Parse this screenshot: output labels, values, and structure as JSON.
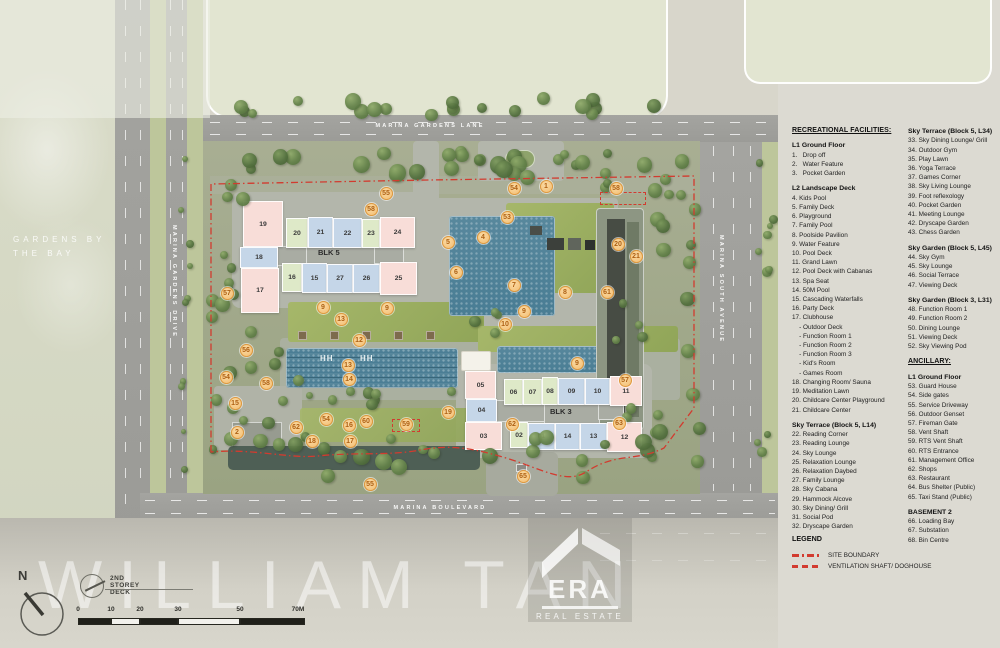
{
  "labels": {
    "watermark": "WILLIAM TAN",
    "area_line1": "GARDENS BY",
    "area_line2": "THE BAY",
    "deck_note": "2ND STOREY DECK",
    "north": "N"
  },
  "roads": {
    "top": "MARINA GARDENS LANE",
    "left": "MARINA GARDENS DRIVE",
    "right": "MARINA SOUTH AVENUE",
    "bottom": "MARINA BOULEVARD"
  },
  "scale_bar": {
    "labels": [
      "0",
      "10",
      "20",
      "30",
      "50",
      "70M"
    ]
  },
  "logo": {
    "name": "ERA",
    "subtitle": "REAL ESTATE"
  },
  "map": {
    "lane_mark": "HH",
    "blocks": [
      {
        "name": "BLK 5",
        "label_x": 318,
        "label_y": 248,
        "cores": [
          {
            "x": 262,
            "y": 246,
            "w": 48,
            "h": 20
          },
          {
            "x": 306,
            "y": 242,
            "w": 70,
            "h": 24
          },
          {
            "x": 374,
            "y": 246,
            "w": 30,
            "h": 18
          }
        ],
        "cells": [
          {
            "label": "19",
            "x": 243,
            "y": 201,
            "w": 40,
            "h": 46,
            "c": "pink"
          },
          {
            "label": "18",
            "x": 240,
            "y": 247,
            "w": 38,
            "h": 21,
            "c": "blue"
          },
          {
            "label": "17",
            "x": 241,
            "y": 268,
            "w": 38,
            "h": 45,
            "c": "pink"
          },
          {
            "label": "20",
            "x": 286,
            "y": 218,
            "w": 22,
            "h": 30,
            "c": "green"
          },
          {
            "label": "21",
            "x": 308,
            "y": 217,
            "w": 25,
            "h": 31,
            "c": "blue"
          },
          {
            "label": "22",
            "x": 333,
            "y": 218,
            "w": 29,
            "h": 30,
            "c": "blue"
          },
          {
            "label": "23",
            "x": 362,
            "y": 219,
            "w": 18,
            "h": 29,
            "c": "green"
          },
          {
            "label": "24",
            "x": 380,
            "y": 217,
            "w": 35,
            "h": 31,
            "c": "pink"
          },
          {
            "label": "16",
            "x": 282,
            "y": 263,
            "w": 20,
            "h": 29,
            "c": "green"
          },
          {
            "label": "15",
            "x": 302,
            "y": 263,
            "w": 25,
            "h": 30,
            "c": "blue"
          },
          {
            "label": "27",
            "x": 327,
            "y": 264,
            "w": 26,
            "h": 29,
            "c": "blue"
          },
          {
            "label": "26",
            "x": 353,
            "y": 264,
            "w": 27,
            "h": 29,
            "c": "blue"
          },
          {
            "label": "25",
            "x": 380,
            "y": 262,
            "w": 37,
            "h": 33,
            "c": "pink"
          }
        ]
      },
      {
        "name": "BLK 3",
        "label_x": 550,
        "label_y": 407,
        "cores": [
          {
            "x": 496,
            "y": 400,
            "w": 50,
            "h": 22
          },
          {
            "x": 544,
            "y": 400,
            "w": 56,
            "h": 24
          },
          {
            "x": 598,
            "y": 404,
            "w": 26,
            "h": 16
          }
        ],
        "cells": [
          {
            "label": "05",
            "x": 465,
            "y": 371,
            "w": 31,
            "h": 28,
            "c": "pink"
          },
          {
            "label": "04",
            "x": 466,
            "y": 399,
            "w": 31,
            "h": 23,
            "c": "blue"
          },
          {
            "label": "03",
            "x": 465,
            "y": 422,
            "w": 37,
            "h": 28,
            "c": "pink"
          },
          {
            "label": "06",
            "x": 504,
            "y": 379,
            "w": 19,
            "h": 26,
            "c": "green"
          },
          {
            "label": "07",
            "x": 523,
            "y": 379,
            "w": 19,
            "h": 26,
            "c": "green"
          },
          {
            "label": "08",
            "x": 542,
            "y": 377,
            "w": 16,
            "h": 28,
            "c": "green"
          },
          {
            "label": "09",
            "x": 558,
            "y": 378,
            "w": 27,
            "h": 27,
            "c": "blue"
          },
          {
            "label": "10",
            "x": 585,
            "y": 378,
            "w": 25,
            "h": 27,
            "c": "blue"
          },
          {
            "label": "11",
            "x": 610,
            "y": 376,
            "w": 32,
            "h": 30,
            "c": "pink"
          },
          {
            "label": "02",
            "x": 510,
            "y": 422,
            "w": 18,
            "h": 26,
            "c": "green"
          },
          {
            "label": "01",
            "x": 528,
            "y": 423,
            "w": 27,
            "h": 27,
            "c": "blue"
          },
          {
            "label": "14",
            "x": 555,
            "y": 423,
            "w": 25,
            "h": 27,
            "c": "blue"
          },
          {
            "label": "13",
            "x": 580,
            "y": 423,
            "w": 27,
            "h": 27,
            "c": "blue"
          },
          {
            "label": "12",
            "x": 607,
            "y": 422,
            "w": 35,
            "h": 30,
            "c": "pink"
          }
        ]
      }
    ],
    "markers": [
      {
        "n": 55,
        "x": 386,
        "y": 193
      },
      {
        "n": 58,
        "x": 371,
        "y": 209
      },
      {
        "n": 54,
        "x": 514,
        "y": 188
      },
      {
        "n": 1,
        "x": 546,
        "y": 186
      },
      {
        "n": 58,
        "x": 616,
        "y": 188
      },
      {
        "n": 53,
        "x": 507,
        "y": 217
      },
      {
        "n": 5,
        "x": 448,
        "y": 242
      },
      {
        "n": 4,
        "x": 483,
        "y": 237
      },
      {
        "n": 6,
        "x": 456,
        "y": 272
      },
      {
        "n": 20,
        "x": 618,
        "y": 244
      },
      {
        "n": 21,
        "x": 636,
        "y": 256
      },
      {
        "n": 7,
        "x": 514,
        "y": 285
      },
      {
        "n": 8,
        "x": 565,
        "y": 292
      },
      {
        "n": 61,
        "x": 607,
        "y": 292
      },
      {
        "n": 57,
        "x": 227,
        "y": 293
      },
      {
        "n": 9,
        "x": 323,
        "y": 307
      },
      {
        "n": 9,
        "x": 387,
        "y": 308
      },
      {
        "n": 9,
        "x": 524,
        "y": 311
      },
      {
        "n": 13,
        "x": 341,
        "y": 319
      },
      {
        "n": 10,
        "x": 505,
        "y": 324
      },
      {
        "n": 12,
        "x": 359,
        "y": 340
      },
      {
        "n": 56,
        "x": 246,
        "y": 350
      },
      {
        "n": 13,
        "x": 348,
        "y": 365
      },
      {
        "n": 9,
        "x": 577,
        "y": 363
      },
      {
        "n": 14,
        "x": 349,
        "y": 379
      },
      {
        "n": 54,
        "x": 226,
        "y": 377
      },
      {
        "n": 58,
        "x": 266,
        "y": 383
      },
      {
        "n": 57,
        "x": 625,
        "y": 380
      },
      {
        "n": 15,
        "x": 235,
        "y": 403
      },
      {
        "n": 19,
        "x": 448,
        "y": 412
      },
      {
        "n": 54,
        "x": 326,
        "y": 419
      },
      {
        "n": 60,
        "x": 366,
        "y": 421
      },
      {
        "n": 16,
        "x": 349,
        "y": 425
      },
      {
        "n": 59,
        "x": 406,
        "y": 424
      },
      {
        "n": 62,
        "x": 296,
        "y": 427
      },
      {
        "n": 62,
        "x": 512,
        "y": 424
      },
      {
        "n": 63,
        "x": 619,
        "y": 423
      },
      {
        "n": 2,
        "x": 237,
        "y": 432
      },
      {
        "n": 18,
        "x": 312,
        "y": 441
      },
      {
        "n": 17,
        "x": 350,
        "y": 441
      },
      {
        "n": 65,
        "x": 523,
        "y": 476
      },
      {
        "n": 55,
        "x": 370,
        "y": 484
      }
    ]
  },
  "legend": {
    "columns": [
      {
        "sections": [
          {
            "heading": "RECREATIONAL FACILITIES:",
            "title": true,
            "items": []
          },
          {
            "heading": "L1 Ground Floor",
            "items": [
              "1.   Drop off",
              "2.   Water Feature",
              "3.   Pocket Garden"
            ]
          },
          {
            "heading": "L2 Landscape Deck",
            "items": [
              "4. Kids Pool",
              "5. Family Deck",
              "6. Playground",
              "7. Family Pool",
              "8. Poolside Pavilion",
              "9. Water Feature",
              "10. Pool Deck",
              "11. Grand Lawn",
              "12. Pool Deck with Cabanas",
              "13. Spa Seat",
              "14. 50M Pool",
              "15. Cascading Waterfalls",
              "16. Party Deck",
              "17. Clubhouse",
              "    - Outdoor Deck",
              "    - Function Room 1",
              "    - Function Room 2",
              "    - Function Room 3",
              "    - Kid's Room",
              "    - Games Room",
              "18. Changing Room/ Sauna",
              "19. Meditation Lawn",
              "20. Childcare Center Playground",
              "21. Childcare Center"
            ]
          },
          {
            "heading": "Sky Terrace (Block 5, L14)",
            "items": [
              "22. Reading Corner",
              "23. Reading Lounge",
              "24. Sky Lounge",
              "25. Relaxation Lounge",
              "26. Relaxation Daybed",
              "27. Family Lounge",
              "28. Sky Cabana",
              "29. Hammock Alcove",
              "30. Sky Dining/ Grill",
              "31. Social Pod",
              "32. Dryscape Garden"
            ]
          }
        ]
      },
      {
        "sections": [
          {
            "heading": "Sky Terrace (Block 5, L34)",
            "items": [
              "33. Sky Dining Lounge/ Grill",
              "34. Outdoor Gym",
              "35. Play Lawn",
              "36. Yoga Terrace",
              "37. Games Corner",
              "38. Sky Living Lounge",
              "39. Foot reflexology",
              "40. Pocket Garden",
              "41. Meeting Lounge",
              "42. Dryscape Garden",
              "43. Chess Garden"
            ]
          },
          {
            "heading": "Sky Garden (Block 5, L45)",
            "items": [
              "44. Sky Gym",
              "45. Sky Lounge",
              "46. Social Terrace",
              "47. Viewing Deck"
            ]
          },
          {
            "heading": "Sky Garden (Block 3, L31)",
            "items": [
              "48. Function Room 1",
              "49. Function Room 2",
              "50. Dining Lounge",
              "51. Viewing Deck",
              "52. Sky Viewing Pod"
            ]
          },
          {
            "heading": "ANCILLARY:",
            "title": true,
            "items": []
          },
          {
            "heading": "L1 Ground Floor",
            "items": [
              "53. Guard House",
              "54. Side gates",
              "55. Service Driveway",
              "56. Outdoor Genset",
              "57. Fireman Gate",
              "58. Vent Shaft",
              "59. RTS Vent Shaft",
              "60. RTS Entrance",
              "61. Management Office",
              "62. Shops",
              "63. Restaurant",
              "64. Bus Shelter (Public)",
              "65. Taxi Stand (Public)"
            ]
          },
          {
            "heading": "BASEMENT 2",
            "items": [
              "66. Loading Bay",
              "67. Substation",
              "68. Bin Centre"
            ]
          }
        ]
      }
    ],
    "key": {
      "title": "LEGEND",
      "items": [
        {
          "label": "SITE BOUNDARY",
          "line": "dashdot"
        },
        {
          "label": "VENTILATION SHAFT/ DOGHOUSE",
          "line": "dashed"
        }
      ]
    }
  },
  "colors": {
    "marker_fill": "#f9d292",
    "marker_border": "#eaa23f",
    "marker_text": "#b26415",
    "boundary_red": "#d23b2f",
    "pool_blue": "#4f86a0",
    "cell_pink": "#f8ddd8",
    "cell_blue": "#c5d6e8",
    "cell_green": "#dee9c8"
  }
}
